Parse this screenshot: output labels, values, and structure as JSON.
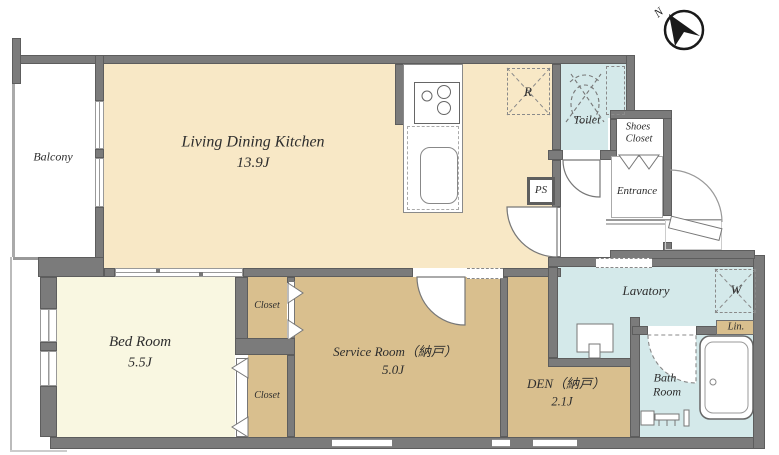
{
  "floorplan": {
    "compass": {
      "north_label": "N"
    },
    "rooms": {
      "ldk": {
        "name": "Living Dining Kitchen",
        "size": "13.9J"
      },
      "balcony": {
        "name": "Balcony"
      },
      "bedroom": {
        "name": "Bed Room",
        "size": "5.5J"
      },
      "service_room": {
        "name": "Service Room（納戸）",
        "size": "5.0J"
      },
      "den": {
        "name": "DEN（納戸）",
        "size": "2.1J"
      },
      "toilet": {
        "name": "Toilet"
      },
      "shoes_closet": {
        "line1": "Shoes",
        "line2": "Closet"
      },
      "entrance": {
        "name": "Entrance"
      },
      "lavatory": {
        "name": "Lavatory"
      },
      "bathroom": {
        "line1": "Bath",
        "line2": "Room"
      },
      "closet_upper": {
        "name": "Closet"
      },
      "closet_lower": {
        "name": "Closet"
      },
      "linen": {
        "name": "Lin."
      }
    },
    "fixtures": {
      "pipe_space": "PS",
      "refrigerator": "R",
      "washer": "W"
    },
    "colors": {
      "wall": "#7b7b7b",
      "ldk_floor": "#f8e8c6",
      "bedroom_floor": "#f9f7e1",
      "storage_floor": "#d9bf8e",
      "wet_area_floor": "#d4e9ea"
    }
  }
}
